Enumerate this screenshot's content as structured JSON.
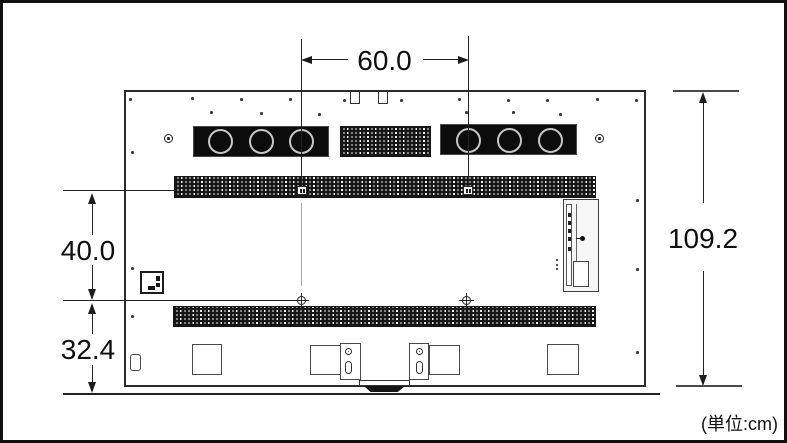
{
  "figure": {
    "unit_note": "(単位:cm)"
  },
  "dimensions": {
    "vesa_width": "60.0",
    "vesa_height": "40.0",
    "bottom_clearance": "32.4",
    "overall_height": "109.2"
  }
}
